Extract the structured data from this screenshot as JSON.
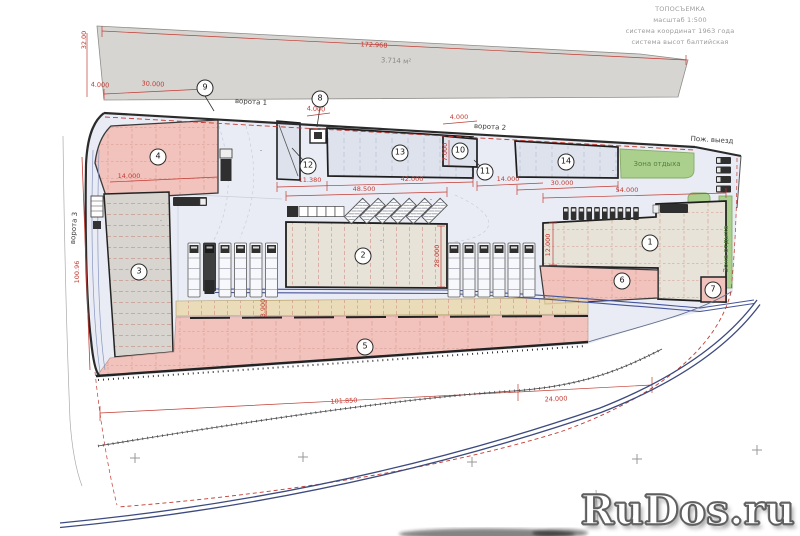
{
  "title_block": {
    "line1": "ТОПОСЪЕМКА",
    "line2": "масштаб 1:500",
    "line3": "система координат 1963 года",
    "line4": "система высот балтийская"
  },
  "parcel": {
    "length_dim": "172.968",
    "width_dim": "32.00",
    "area_label": "3.714 м²"
  },
  "watermark": {
    "text": "RuDos.ru"
  },
  "zone_markers": [
    {
      "num": "1",
      "x": 650,
      "y": 243
    },
    {
      "num": "2",
      "x": 363,
      "y": 256
    },
    {
      "num": "3",
      "x": 139,
      "y": 272
    },
    {
      "num": "4",
      "x": 158,
      "y": 157
    },
    {
      "num": "5",
      "x": 365,
      "y": 347
    },
    {
      "num": "6",
      "x": 622,
      "y": 281
    },
    {
      "num": "7",
      "x": 713,
      "y": 290
    },
    {
      "num": "8",
      "x": 320,
      "y": 99
    },
    {
      "num": "9",
      "x": 205,
      "y": 88
    },
    {
      "num": "10",
      "x": 460,
      "y": 151
    },
    {
      "num": "11",
      "x": 485,
      "y": 172
    },
    {
      "num": "12",
      "x": 308,
      "y": 166
    },
    {
      "num": "13",
      "x": 400,
      "y": 153
    },
    {
      "num": "14",
      "x": 566,
      "y": 162
    }
  ],
  "dimensions": [
    {
      "text": "172.968",
      "x": 374,
      "y": 45,
      "rot": 2.8
    },
    {
      "text": "32.00",
      "x": 84,
      "y": 40,
      "rot": -90
    },
    {
      "text": "4.000",
      "x": 100,
      "y": 85,
      "rot": 3
    },
    {
      "text": "30.000",
      "x": 153,
      "y": 84,
      "rot": 3
    },
    {
      "text": "4.000",
      "x": 316,
      "y": 109,
      "rot": 3
    },
    {
      "text": "4.000",
      "x": 459,
      "y": 117,
      "rot": 0
    },
    {
      "text": "14.000",
      "x": 129,
      "y": 176,
      "rot": 0
    },
    {
      "text": "11.380",
      "x": 310,
      "y": 180,
      "rot": 0
    },
    {
      "text": "42.000",
      "x": 412,
      "y": 179,
      "rot": 0
    },
    {
      "text": "48.500",
      "x": 364,
      "y": 189,
      "rot": 0
    },
    {
      "text": "14.000",
      "x": 508,
      "y": 179,
      "rot": 0
    },
    {
      "text": "30.000",
      "x": 562,
      "y": 183,
      "rot": 0
    },
    {
      "text": "54.000",
      "x": 627,
      "y": 190,
      "rot": 0
    },
    {
      "text": "7.000",
      "x": 445,
      "y": 152,
      "rot": -90
    },
    {
      "text": "28.000",
      "x": 437,
      "y": 256,
      "rot": -90
    },
    {
      "text": "12.000",
      "x": 548,
      "y": 245,
      "rot": -90
    },
    {
      "text": "3.900",
      "x": 263,
      "y": 308,
      "rot": -90
    },
    {
      "text": "100.96",
      "x": 77,
      "y": 272,
      "rot": -90
    },
    {
      "text": "101.850",
      "x": 344,
      "y": 401,
      "rot": -3
    },
    {
      "text": "24.000",
      "x": 556,
      "y": 399,
      "rot": -2.5
    }
  ],
  "text_labels": [
    {
      "text": "ворота 1",
      "x": 251,
      "y": 102,
      "rot": 3.5,
      "color": "#3a3a3a"
    },
    {
      "text": "ворота 2",
      "x": 490,
      "y": 127,
      "rot": 3.5,
      "color": "#3a3a3a"
    },
    {
      "text": "ворота 3",
      "x": 74,
      "y": 228,
      "rot": -86,
      "color": "#3a3a3a"
    },
    {
      "text": "Пож. выезд",
      "x": 712,
      "y": 140,
      "rot": 3.5,
      "color": "#3a3a3a"
    },
    {
      "text": "Зона отдыха",
      "x": 657,
      "y": 164,
      "rot": 0,
      "color": "#55803f"
    },
    {
      "text": "Зона отдыха",
      "x": 726,
      "y": 249,
      "rot": -90,
      "color": "#55803f"
    },
    {
      "text": "3.714 м²",
      "x": 396,
      "y": 61,
      "rot": 2.8,
      "color": "#8a8a8a"
    }
  ],
  "colors": {
    "dimension_red": "#c23b32",
    "boundary_dark": "#2b2b2b",
    "zone_pink": "#f2c2bc",
    "zone_gray": "#d8d5d0",
    "zone_beige": "#e7e3d8",
    "building_blue": "#dde2ed",
    "rest_green": "#abd08e",
    "yard_blue": "#e9ecf4",
    "rail_blue": "#3c4a7e",
    "parcel_gray": "#d7d5d1",
    "tan_strip": "#ead9ad"
  }
}
